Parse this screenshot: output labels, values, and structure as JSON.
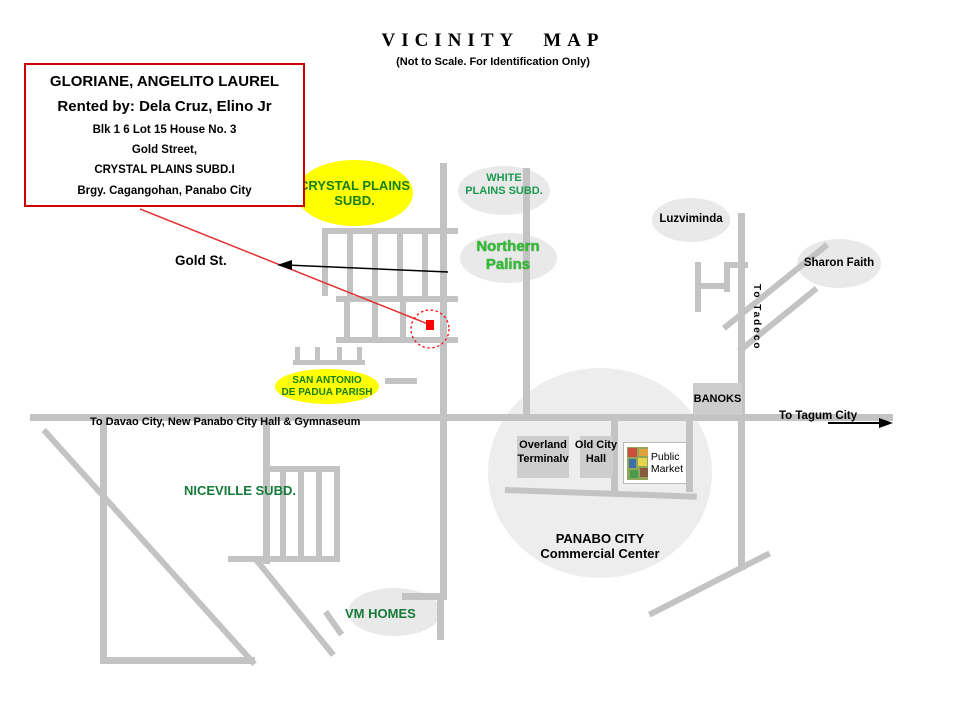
{
  "header": {
    "title": "VICINITY MAP",
    "subtitle": "(Not to Scale. For Identification  Only)"
  },
  "info_box": {
    "line1": "GLORIANE, ANGELITO LAUREL",
    "line2": "Rented by: Dela Cruz, Elino Jr",
    "line3": "Blk 1 6 Lot 15  House No. 3",
    "line4": "Gold  Street,",
    "line5": "CRYSTAL PLAINS  SUBD.I",
    "line6": "Brgy. Cagangohan, Panabo City"
  },
  "labels": {
    "crystal_plains": {
      "line1": "CRYSTAL PLAINS",
      "line2": "SUBD."
    },
    "white_plains": {
      "line1": "WHITE",
      "line2": "PLAINS SUBD."
    },
    "northern_palins": {
      "line1": "Northern",
      "line2": "Palins"
    },
    "luzviminda": "Luzviminda",
    "sharon_faith": "Sharon Faith",
    "to_tadeco": "To Tadeco",
    "gold_st": "Gold St.",
    "san_antonio": {
      "line1": "SAN ANTONIO",
      "line2": "DE PADUA PARISH"
    },
    "banoks": "BANOKS",
    "to_davao": "To Davao City, New Panabo City Hall & Gymnaseum",
    "to_tagum": "To Tagum City",
    "overland": {
      "line1": "Overland",
      "line2": "Terminalv"
    },
    "old_city_hall": {
      "line1": "Old City",
      "line2": "Hall"
    },
    "public_market": {
      "line1": "Public",
      "line2": "Market"
    },
    "panabo_city": {
      "line1": "PANABO CITY",
      "line2": "Commercial Center"
    },
    "niceville": "NICEVILLE SUBD.",
    "vm_homes": "VM HOMES"
  },
  "colors": {
    "road_gray": "#C3C3C3",
    "highlight_yellow": "#FFFF00",
    "info_box_red": "#D00000",
    "marker_red": "#FF0000",
    "leader_red": "#E03535",
    "subdivision_green_dark": "#188018",
    "subdivision_green_bright": "#2FBE2F",
    "ellipse_gray": "#E9E9E9",
    "commercial_circle_gray": "#EDEDED"
  }
}
